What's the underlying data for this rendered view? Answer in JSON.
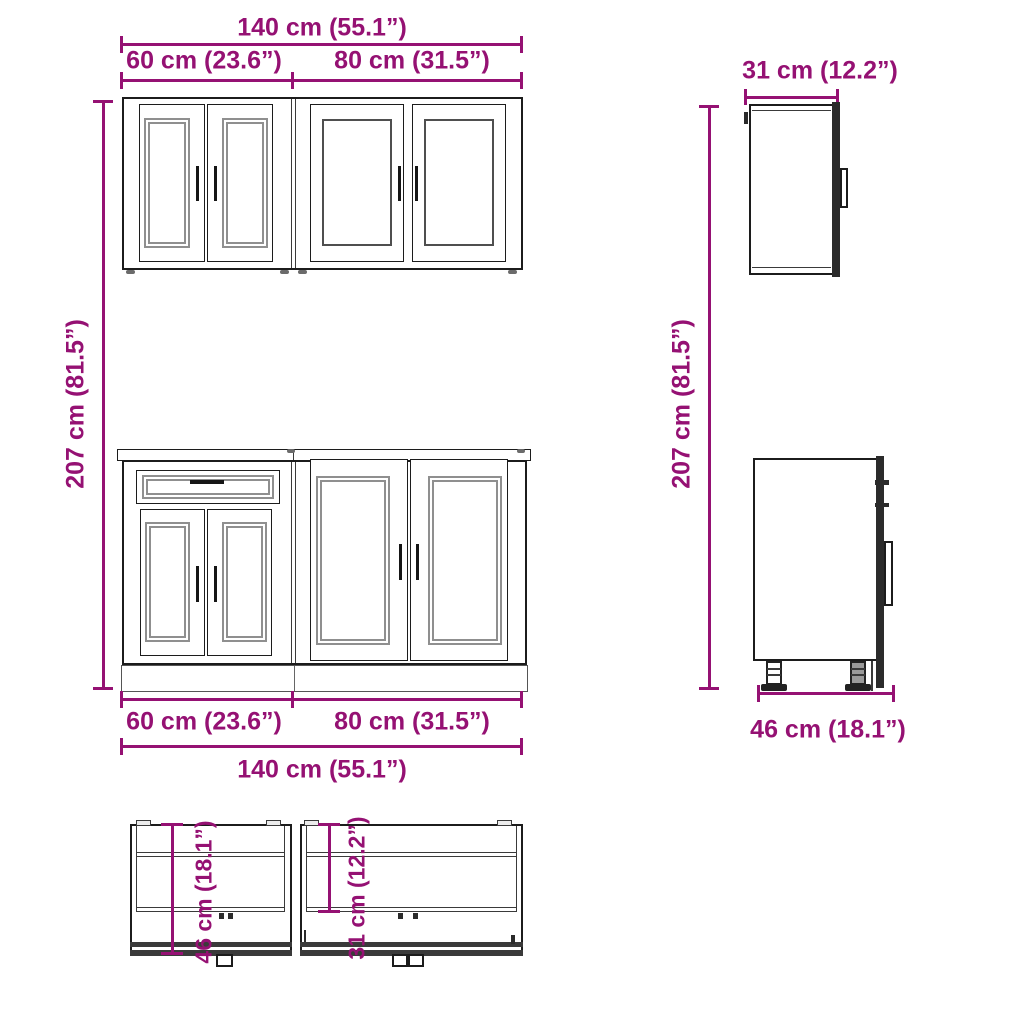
{
  "title": "Kitchen cabinet set technical dimension drawing",
  "colors": {
    "dimension_magenta": "#951173",
    "outline_black": "#1c1c1c",
    "panel_gray": "#8f8f8f",
    "background": "#ffffff"
  },
  "dimensions": {
    "front": {
      "total_width": "140 cm (55.1”)",
      "left_width": "60 cm (23.6”)",
      "right_width": "80 cm (31.5”)",
      "height": "207 cm (81.5”)"
    },
    "side": {
      "height": "207 cm (81.5”)",
      "wall_cabinet_depth": "31 cm (12.2”)",
      "base_cabinet_depth": "46 cm (18.1”)"
    },
    "top": {
      "base_cabinet_depth": "46 cm (18.1”)",
      "wall_cabinet_depth": "31 cm (12.2”)"
    }
  }
}
